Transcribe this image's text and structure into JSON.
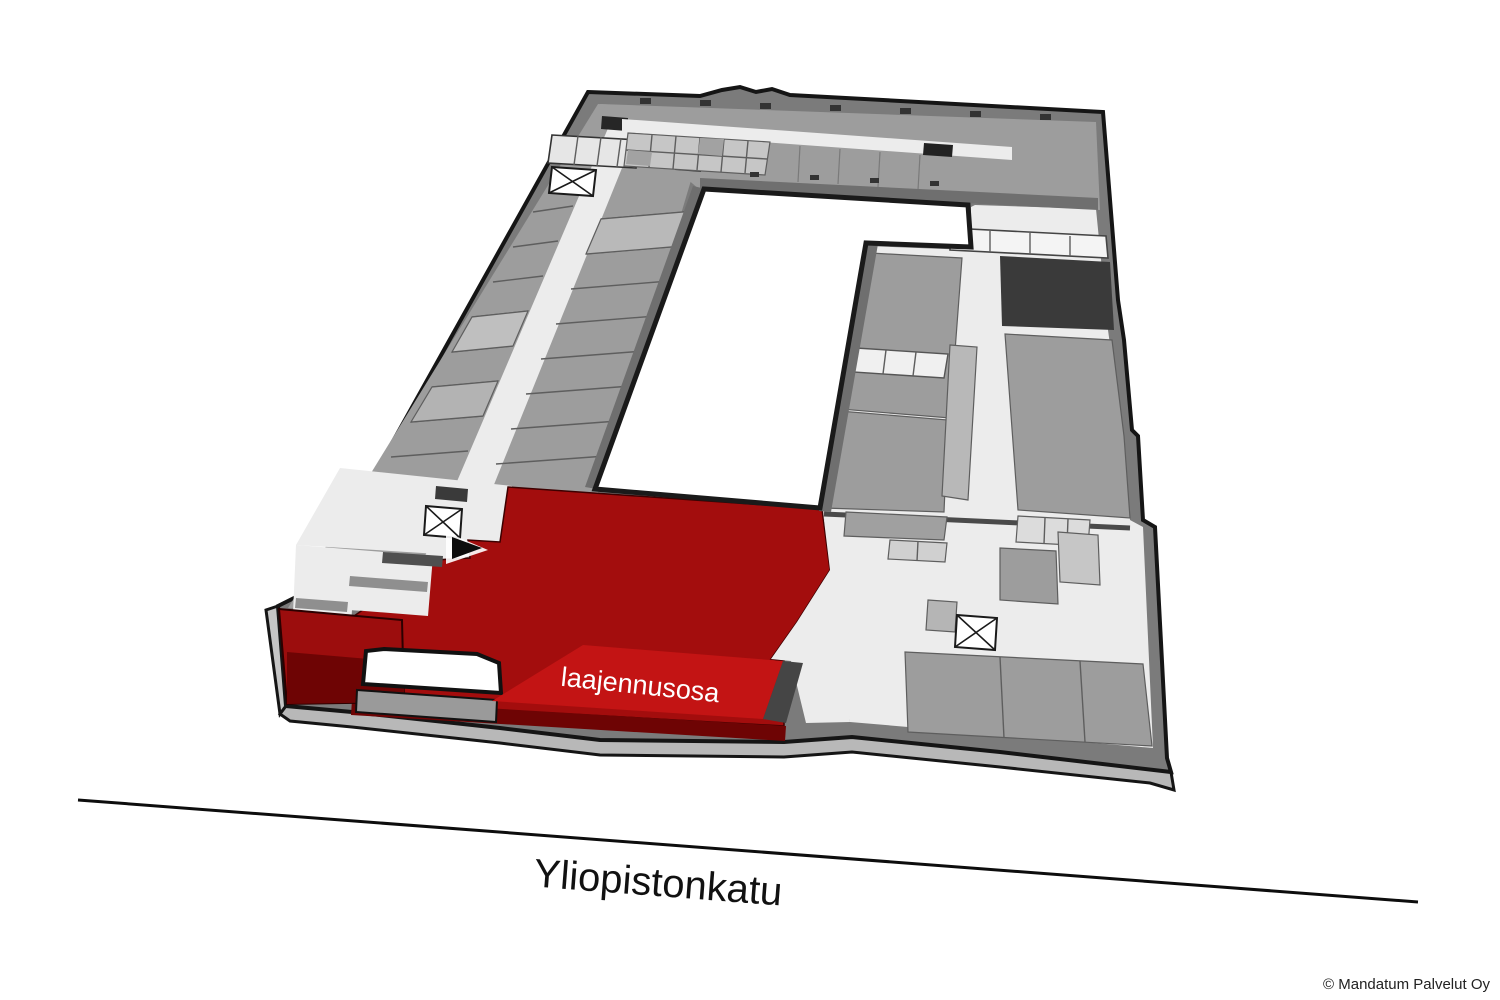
{
  "canvas": {
    "width": 1500,
    "height": 1000,
    "background": "#ffffff"
  },
  "floor_plan": {
    "type": "3d-building-floor-plan",
    "highlighted_area": {
      "label": "laajennusosa",
      "front_fill": "#c31414",
      "top_fill": "#a30d0d",
      "side_fill": "#6e0404",
      "corner_fill": "#9c0d0d",
      "text_color": "#ffffff"
    },
    "street": {
      "name": "Yliopistonkatu"
    },
    "copyright": {
      "text": "© Mandatum Palvelut Oy"
    },
    "colors": {
      "outline": "#151515",
      "outer_wall": "#7b7b7b",
      "floor_medium": "#9d9d9d",
      "floor_light": "#ececec",
      "room_dark": "#3a3a3a",
      "courtyard": "#ffffff",
      "skirt": "#b8b8b8",
      "wall_band": "#6f6f6f"
    },
    "icons": {
      "elevators": 3,
      "entrance_arrow": 1
    }
  }
}
